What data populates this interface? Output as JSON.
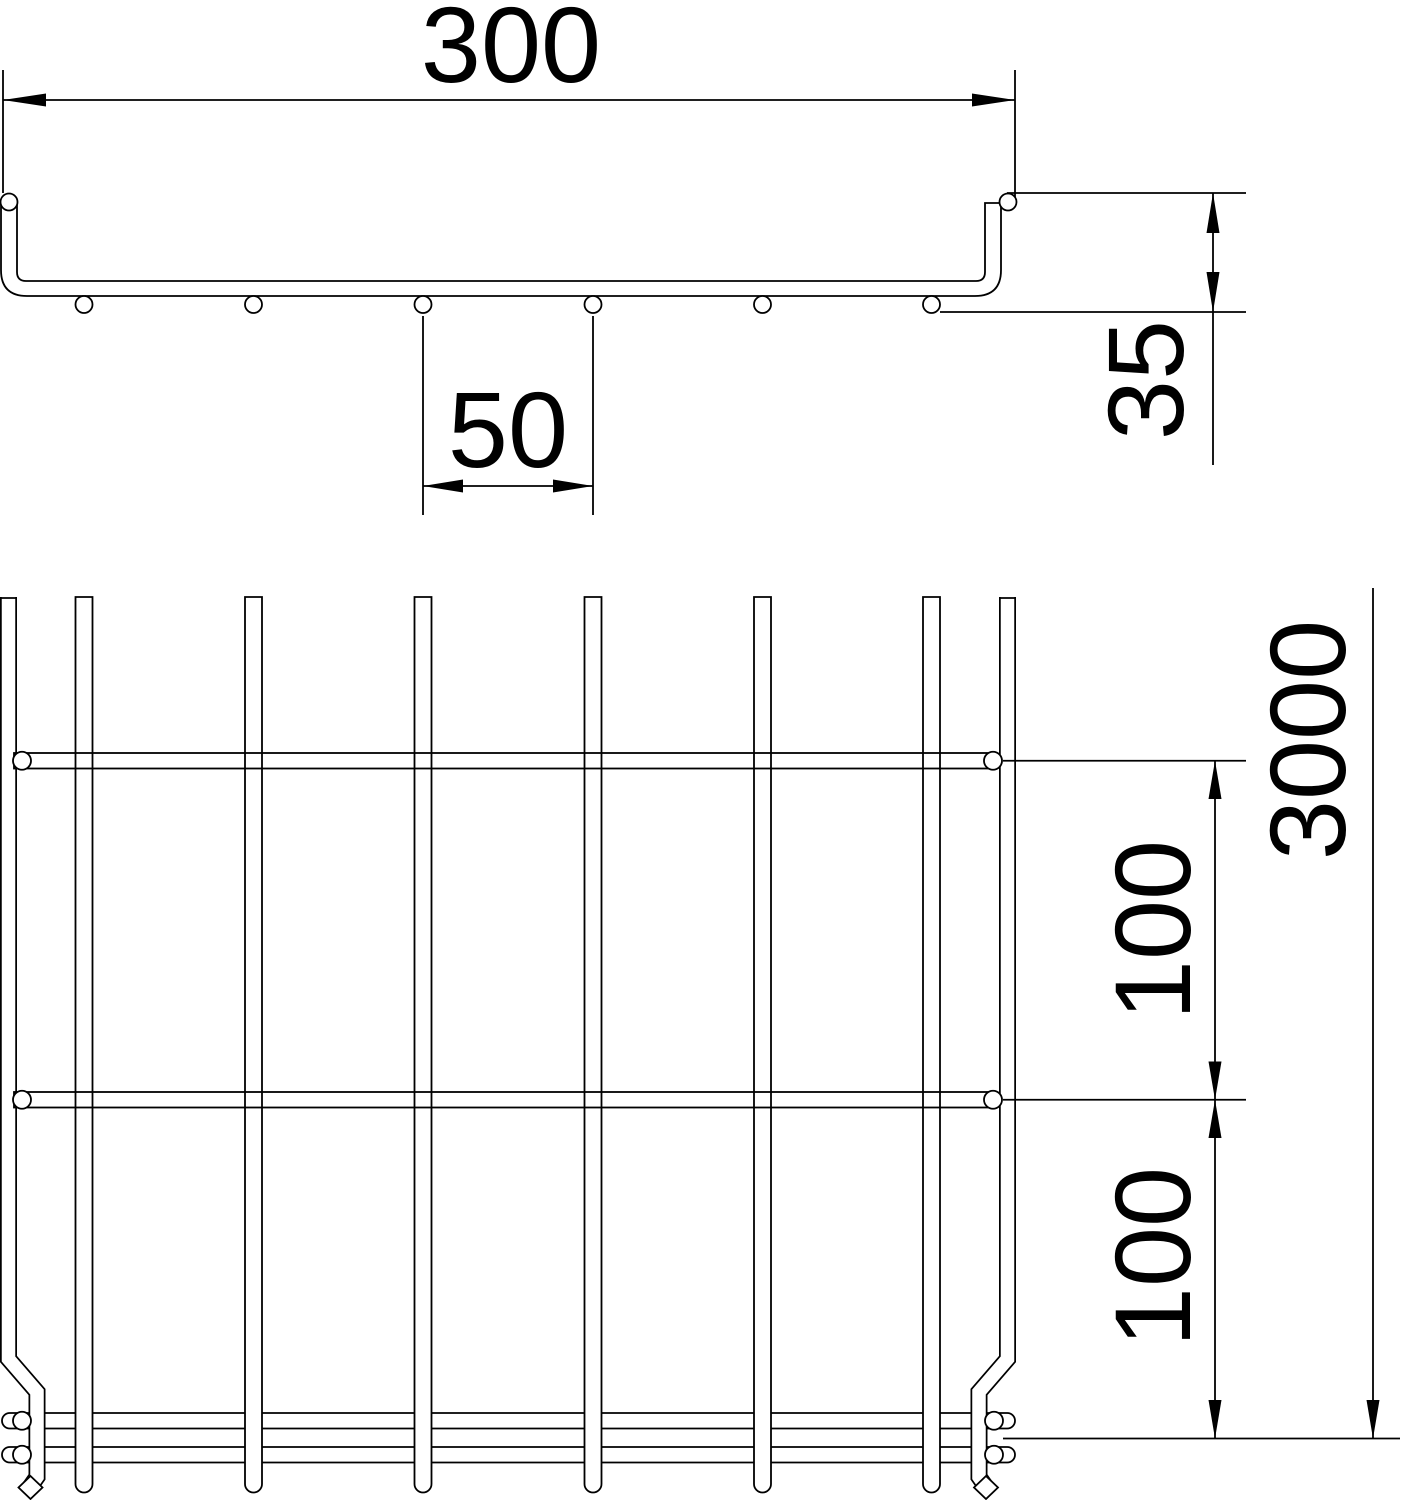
{
  "cross_section": {
    "width": "300",
    "wire_spacing": "50",
    "height": "35"
  },
  "plan": {
    "length": "3000",
    "rung_spacing_1": "100",
    "rung_spacing_2": "100"
  },
  "colors": {
    "line": "#000000",
    "background": "#ffffff"
  }
}
